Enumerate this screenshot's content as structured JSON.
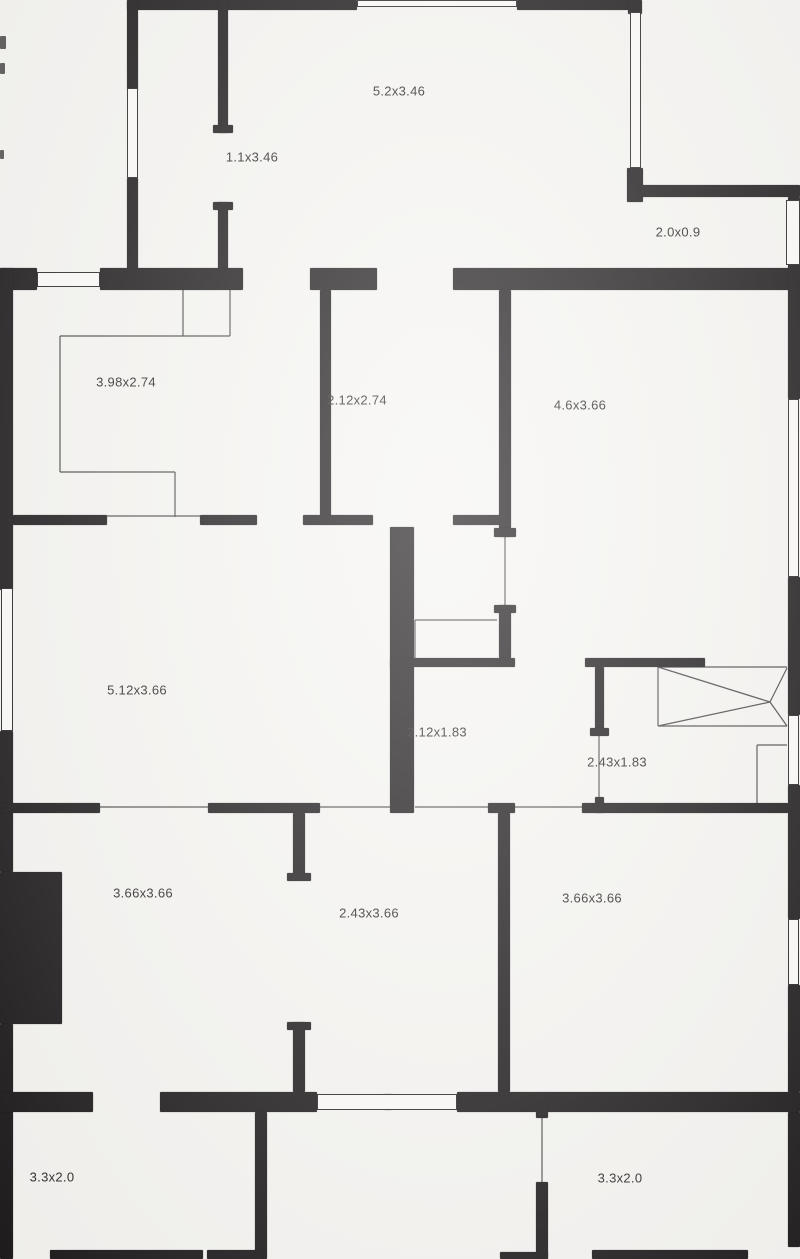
{
  "document": {
    "kind": "scanned floor plan",
    "paper_color": "#f6f5f2",
    "wall_color": "#1f1c1d",
    "thin_line_color": "#4d4a4a",
    "label_color": "#2f2b2a"
  },
  "rooms": [
    {
      "id": "room-1",
      "label": "5.2x3.46",
      "cx": 399,
      "cy": 91
    },
    {
      "id": "room-2",
      "label": "1.1x3.46",
      "cx": 252,
      "cy": 157
    },
    {
      "id": "room-3",
      "label": "2.0x0.9",
      "cx": 678,
      "cy": 232
    },
    {
      "id": "room-4",
      "label": "3.98x2.74",
      "cx": 126,
      "cy": 382
    },
    {
      "id": "room-5",
      "label": "2.12x2.74",
      "cx": 357,
      "cy": 400
    },
    {
      "id": "room-6",
      "label": "4.6x3.66",
      "cx": 580,
      "cy": 405
    },
    {
      "id": "room-7",
      "label": "5.12x3.66",
      "cx": 137,
      "cy": 690
    },
    {
      "id": "room-8",
      "label": "2.12x1.83",
      "cx": 437,
      "cy": 732
    },
    {
      "id": "room-9",
      "label": "2.43x1.83",
      "cx": 617,
      "cy": 762
    },
    {
      "id": "room-10",
      "label": "3.66x3.66",
      "cx": 143,
      "cy": 893
    },
    {
      "id": "room-11",
      "label": "2.43x3.66",
      "cx": 369,
      "cy": 913
    },
    {
      "id": "room-12",
      "label": "3.66x3.66",
      "cx": 592,
      "cy": 898
    },
    {
      "id": "room-13",
      "label": "3.3x2.0",
      "cx": 52,
      "cy": 1177
    },
    {
      "id": "room-14",
      "label": "3.3x2.0",
      "cx": 620,
      "cy": 1178
    }
  ],
  "walls": [
    [
      127,
      0,
      230,
      10
    ],
    [
      517,
      0,
      118,
      10
    ],
    [
      127,
      0,
      11,
      90
    ],
    [
      127,
      178,
      11,
      94
    ],
    [
      218,
      0,
      10,
      133
    ],
    [
      213,
      125,
      20,
      8
    ],
    [
      213,
      202,
      20,
      8
    ],
    [
      218,
      202,
      10,
      70
    ],
    [
      628,
      0,
      14,
      14
    ],
    [
      627,
      168,
      16,
      34
    ],
    [
      637,
      185,
      163,
      12
    ],
    [
      789,
      202,
      9,
      6
    ],
    [
      789,
      247,
      9,
      6
    ],
    [
      0,
      268,
      37,
      22
    ],
    [
      100,
      268,
      143,
      22
    ],
    [
      310,
      268,
      67,
      22
    ],
    [
      453,
      268,
      342,
      22
    ],
    [
      0,
      268,
      13,
      322
    ],
    [
      0,
      731,
      13,
      141
    ],
    [
      0,
      872,
      62,
      152
    ],
    [
      0,
      1024,
      13,
      235
    ],
    [
      788,
      197,
      12,
      202
    ],
    [
      788,
      577,
      12,
      138
    ],
    [
      788,
      785,
      12,
      134
    ],
    [
      788,
      985,
      12,
      107
    ],
    [
      788,
      1112,
      12,
      135
    ],
    [
      320,
      290,
      11,
      227
    ],
    [
      499,
      290,
      12,
      247
    ],
    [
      494,
      528,
      22,
      9
    ],
    [
      494,
      605,
      22,
      8
    ],
    [
      499,
      605,
      12,
      53
    ],
    [
      13,
      515,
      94,
      10
    ],
    [
      200,
      515,
      57,
      10
    ],
    [
      303,
      515,
      70,
      10
    ],
    [
      453,
      515,
      47,
      10
    ],
    [
      390,
      527,
      24,
      286
    ],
    [
      390,
      658,
      125,
      9
    ],
    [
      585,
      658,
      120,
      9
    ],
    [
      595,
      667,
      9,
      68
    ],
    [
      590,
      728,
      19,
      8
    ],
    [
      595,
      797,
      9,
      16
    ],
    [
      0,
      803,
      100,
      10
    ],
    [
      208,
      803,
      112,
      10
    ],
    [
      488,
      803,
      27,
      10
    ],
    [
      582,
      803,
      206,
      10
    ],
    [
      293,
      813,
      12,
      67
    ],
    [
      287,
      873,
      24,
      8
    ],
    [
      287,
      1022,
      24,
      8
    ],
    [
      293,
      1022,
      12,
      70
    ],
    [
      498,
      813,
      12,
      279
    ],
    [
      0,
      1092,
      93,
      20
    ],
    [
      160,
      1092,
      157,
      20
    ],
    [
      457,
      1092,
      343,
      20
    ],
    [
      384,
      1094,
      8,
      16
    ],
    [
      255,
      1112,
      12,
      147
    ],
    [
      536,
      1108,
      12,
      10
    ],
    [
      536,
      1182,
      12,
      77
    ],
    [
      50,
      1250,
      153,
      9
    ],
    [
      207,
      1250,
      56,
      9
    ],
    [
      500,
      1252,
      48,
      7
    ],
    [
      592,
      1250,
      156,
      9
    ]
  ],
  "windows": [
    [
      357,
      0,
      160,
      7
    ],
    [
      127,
      88,
      11,
      90
    ],
    [
      630,
      12,
      11,
      156
    ],
    [
      37,
      272,
      63,
      15
    ],
    [
      1,
      588,
      12,
      143
    ],
    [
      788,
      399,
      11,
      178
    ],
    [
      788,
      715,
      11,
      70
    ],
    [
      788,
      919,
      11,
      66
    ],
    [
      317,
      1094,
      140,
      16
    ],
    [
      786,
      200,
      14,
      65
    ]
  ],
  "thin_lines": [
    [
      183,
      290,
      183,
      336
    ],
    [
      230,
      290,
      230,
      336
    ],
    [
      60,
      336,
      230,
      336
    ],
    [
      60,
      336,
      60,
      472
    ],
    [
      60,
      472,
      175,
      472
    ],
    [
      175,
      472,
      175,
      517
    ],
    [
      415,
      620,
      497,
      620
    ],
    [
      415,
      620,
      415,
      658
    ],
    [
      107,
      516,
      200,
      516
    ],
    [
      100,
      807,
      208,
      807
    ],
    [
      320,
      807,
      390,
      807
    ],
    [
      415,
      807,
      488,
      807
    ],
    [
      515,
      807,
      582,
      807
    ],
    [
      505,
      537,
      505,
      605
    ],
    [
      599,
      735,
      599,
      797
    ],
    [
      542,
      1117,
      542,
      1182
    ],
    [
      658,
      667,
      787,
      667
    ],
    [
      658,
      667,
      658,
      726
    ],
    [
      658,
      726,
      787,
      726
    ],
    [
      658,
      667,
      770,
      702
    ],
    [
      658,
      726,
      770,
      702
    ],
    [
      770,
      702,
      787,
      668
    ],
    [
      770,
      702,
      787,
      726
    ],
    [
      757,
      745,
      787,
      745
    ],
    [
      757,
      745,
      757,
      803
    ]
  ],
  "artifacts": [
    [
      0,
      36,
      6,
      13
    ],
    [
      0,
      63,
      5,
      11
    ],
    [
      0,
      150,
      4,
      9
    ]
  ]
}
